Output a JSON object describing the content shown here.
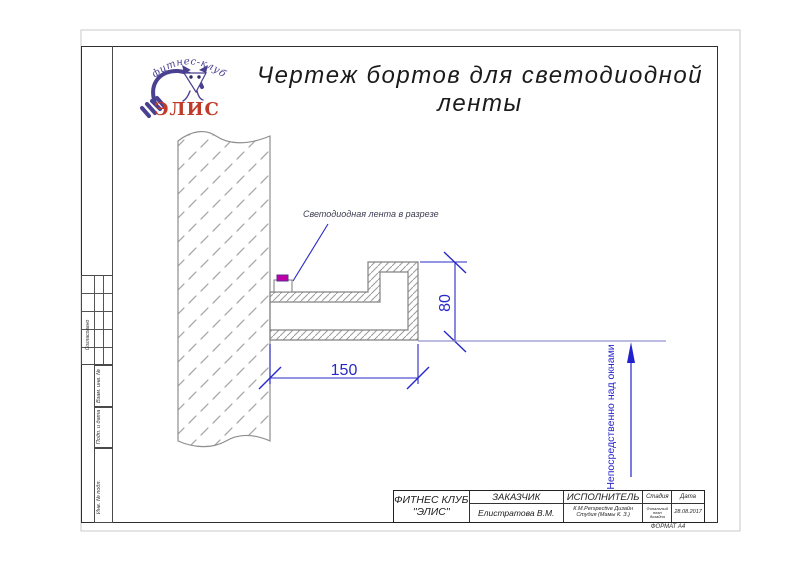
{
  "title": "Чертеж бортов для светодиодной ленты",
  "logo": {
    "club_type": "фитнес-клуб",
    "club_name": "ЭЛИС"
  },
  "drawing": {
    "callout": "Светодиодная лента в разрезе",
    "dim_width": "150",
    "dim_height": "80",
    "vertical_note": "Непосредственно над окнами",
    "colors": {
      "dimension_blue": "#2828c8",
      "led_magenta": "#bf00a8",
      "note_line_lavender": "#9595cf",
      "outline_gray": "#858585",
      "logo_purple": "#4a4090",
      "logo_red": "#c23b2a"
    }
  },
  "side_strip": {
    "approved_label": "Согласовано",
    "field_labels": [
      "Взам. инв. №",
      "Подп. и дата",
      "Инв. № подл."
    ]
  },
  "title_block": {
    "company": {
      "line1": "ФИТНЕС КЛУБ",
      "line2": "''ЭЛИС''"
    },
    "customer": {
      "label": "ЗАКАЗЧИК",
      "value": "Елистратова В.М."
    },
    "contractor": {
      "label": "ИСПОЛНИТЕЛЬ",
      "value_line1": "К.М.Perspective Дизайн",
      "value_line2": "Студия (Мамы К. З.)"
    },
    "stage": {
      "label": "Стадия",
      "value_line1": "Финальный",
      "value_line2": "план",
      "value_line3": "дизайна"
    },
    "date": {
      "label": "Дата",
      "value": "28.08.2017"
    },
    "format_note": "ФОРМАТ А4"
  }
}
